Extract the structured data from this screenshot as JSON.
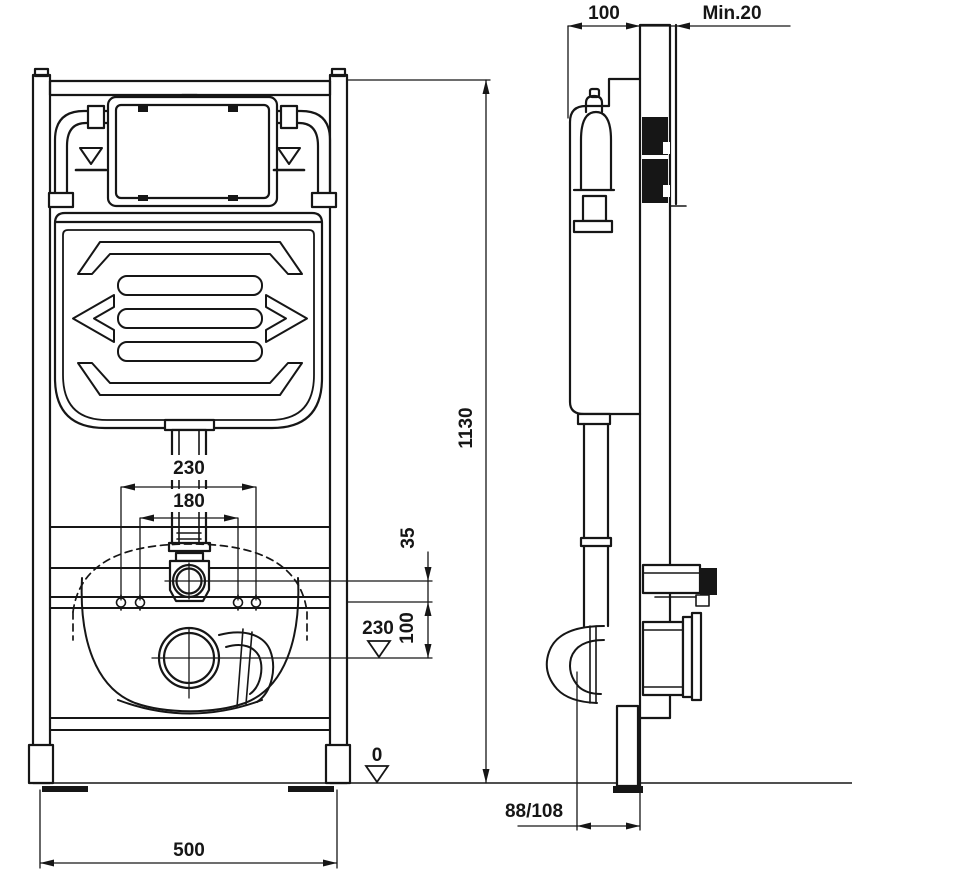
{
  "dimensions": {
    "front": {
      "bolt_spacing_outer": "230",
      "bolt_spacing_inner": "180",
      "total_height": "1130",
      "supply_to_rail": "35",
      "rail_to_outlet": "100",
      "outlet_height": "230",
      "floor_level": "0",
      "frame_width": "500"
    },
    "side": {
      "frame_depth": "100",
      "min_clearance": "Min.20",
      "outlet_wall_distance": "88/108"
    }
  }
}
